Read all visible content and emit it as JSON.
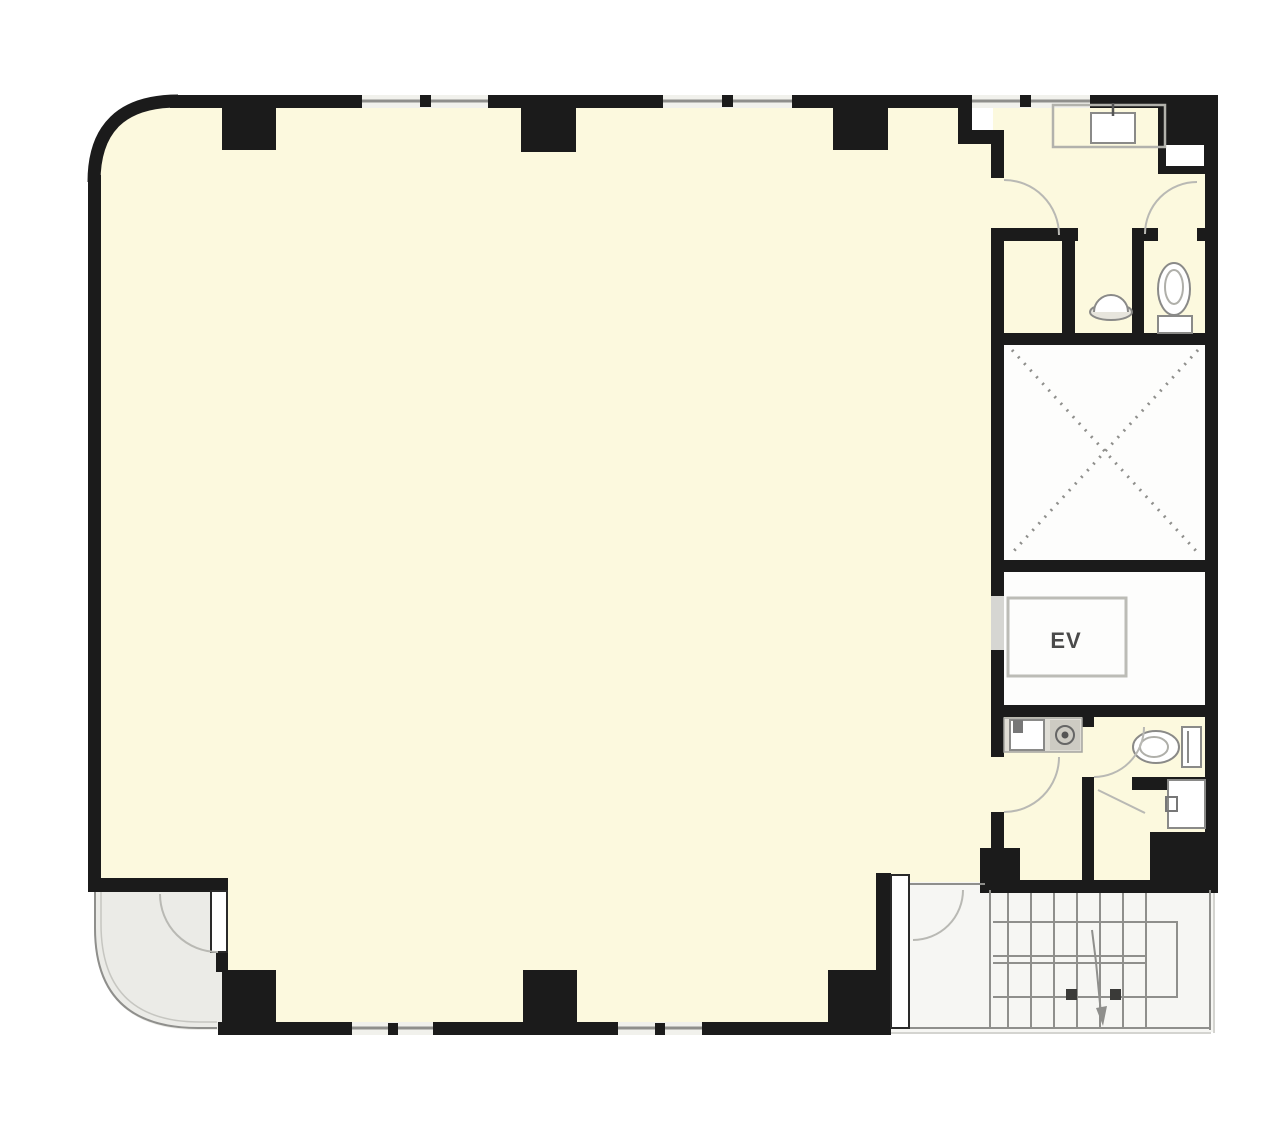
{
  "labels": {
    "elevator": "EV"
  },
  "colors": {
    "wall": "#1B1B1B",
    "cream": "#FCF9DE",
    "white": "#FDFDFC",
    "entrance": "#EBEBE7",
    "stair": "#F6F6F3",
    "gray": "#8F8F8C",
    "light": "#C6C6C1",
    "fixture": "#8A8A88",
    "counter": "#E0DED6",
    "text": "#4A4A4A"
  },
  "fixtures": [
    "vanity-sink",
    "pipe-shaft",
    "urinal",
    "toilet-upper",
    "elevator-shaft-x",
    "elevator-car",
    "kitchen-sink",
    "stove",
    "toilet-lower",
    "hand-sink",
    "stair-flight",
    "stair-arrow",
    "entrance-door",
    "stair-door"
  ]
}
